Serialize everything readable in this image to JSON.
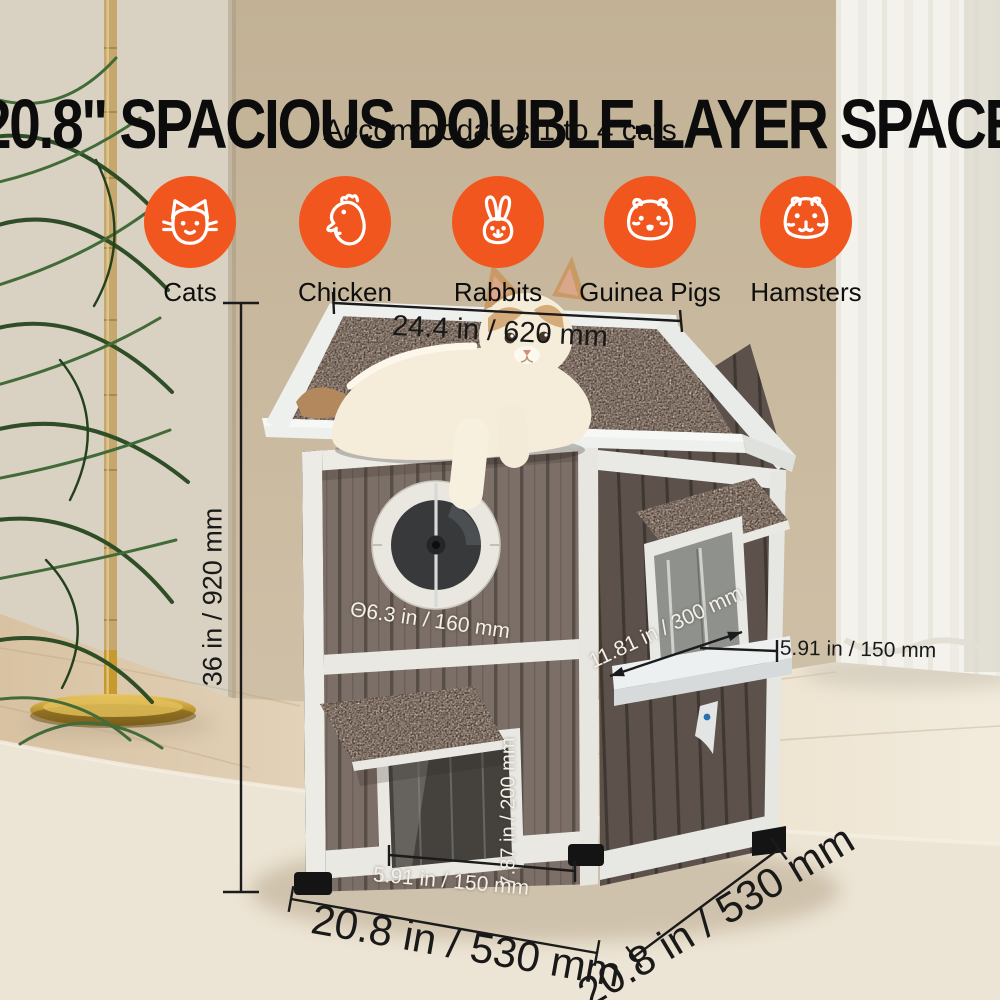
{
  "title": "20.8\" SPACIOUS DOUBLE-LAYER SPACE",
  "subtitle": "Accommodates 1 to 4 cats",
  "animals": [
    {
      "label": "Cats",
      "icon": "cat-icon"
    },
    {
      "label": "Chicken",
      "icon": "chicken-icon"
    },
    {
      "label": "Rabbits",
      "icon": "rabbit-icon"
    },
    {
      "label": "Guinea Pigs",
      "icon": "guinea-pig-icon"
    },
    {
      "label": "Hamsters",
      "icon": "hamster-icon"
    }
  ],
  "dimensions": {
    "roof_width": "24.4 in / 620 mm",
    "total_height": "36 in / 920 mm",
    "window_diameter": "Θ6.3 in / 160 mm",
    "perch_depth": "11.81 in / 300 mm",
    "shelf_depth": "5.91 in / 150 mm",
    "door_height": "7.87 in / 200 mm",
    "door_width": "5.91 in / 150 mm",
    "base_front": "20.8 in / 530 mm",
    "base_side": "20.8 in / 530 mm"
  },
  "colors": {
    "accent": "#F0561D",
    "annotation_dark": "#191919",
    "annotation_light": "#F4F1E9"
  }
}
